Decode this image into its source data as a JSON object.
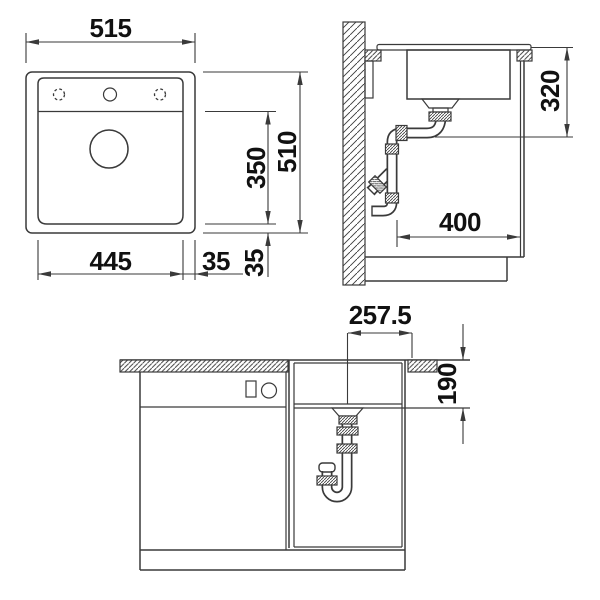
{
  "page": {
    "background": "#ffffff"
  },
  "drawing": {
    "type": "technical-installation-drawing",
    "subject": "kitchen sink with cabinet, three orthographic views with dimensions (mm)",
    "line_color": "#3a3a3a",
    "text_color": "#111111",
    "views": {
      "top": {
        "name": "sink plan view",
        "dims": {
          "overall_width": "515",
          "overall_depth": "510",
          "bowl_depth": "350",
          "bowl_width": "445",
          "rim_side": "35",
          "rim_front": "35"
        },
        "features": [
          "faucet-hole-left-optional",
          "faucet-hole-center",
          "faucet-hole-right-optional",
          "drain"
        ]
      },
      "side": {
        "name": "side section view",
        "dims": {
          "under_counter_depth": "320",
          "drain_clearance": "400"
        },
        "features": [
          "wall",
          "countertop",
          "bowl",
          "strainer",
          "drain-pipes",
          "cabinet",
          "plinth"
        ]
      },
      "front": {
        "name": "front section view",
        "dims": {
          "center_to_edge": "257.5",
          "counter_to_bowl_bottom": "190"
        },
        "features": [
          "countertop",
          "bowl",
          "strainer",
          "s-trap",
          "cabinet-door",
          "drawer-front",
          "handle-symbols",
          "plinth"
        ]
      }
    }
  }
}
